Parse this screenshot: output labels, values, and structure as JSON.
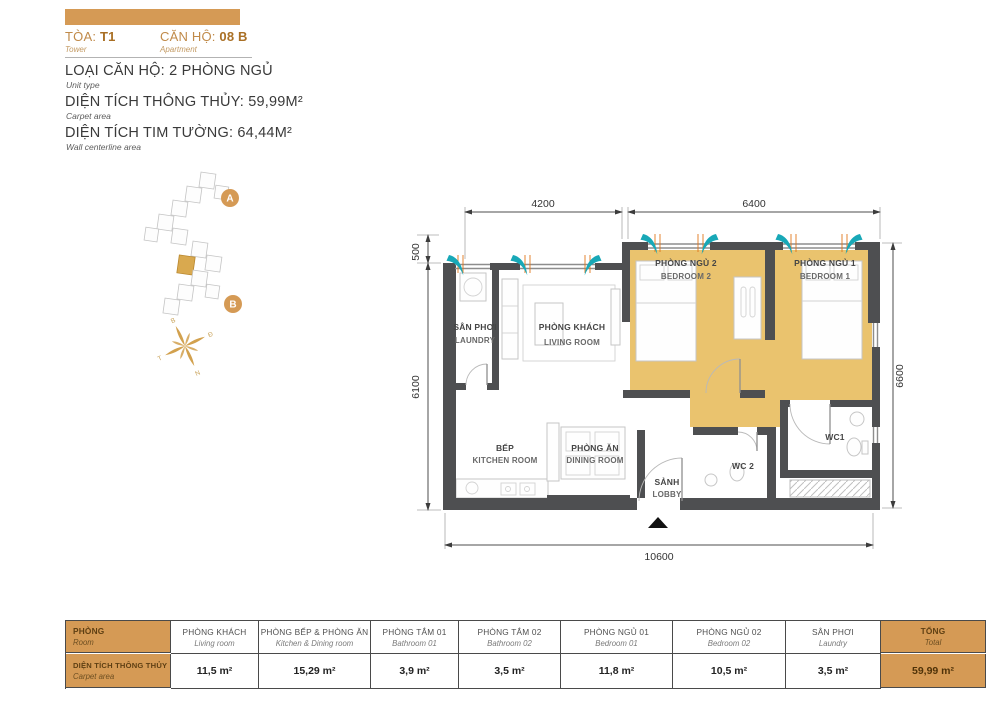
{
  "header": {
    "tower_label": "TÒA:",
    "tower_value": "T1",
    "tower_sub": "Tower",
    "apt_label": "CĂN HỘ:",
    "apt_value": "08 B",
    "apt_sub": "Apartment",
    "line1": "LOẠI CĂN HỘ: 2 PHÒNG NGỦ",
    "line1_sub": "Unit type",
    "line2": "DIỆN TÍCH THÔNG THỦY: 59,99M²",
    "line2_sub": "Carpet area",
    "line3": "DIỆN TÍCH TIM TƯỜNG: 64,44M²",
    "line3_sub": "Wall centerline area"
  },
  "tower_map": {
    "badge_a": "A",
    "badge_b": "B",
    "compass": {
      "n": "B",
      "e": "Đ",
      "s": "N",
      "w": "T"
    }
  },
  "plan": {
    "dimensions": {
      "top_left": "4200",
      "top_right": "6400",
      "left_top": "500",
      "left": "6100",
      "right": "6600",
      "bottom": "10600"
    },
    "rooms": {
      "laundry": {
        "vn": "SÂN PHƠI",
        "en": "LAUNDRY"
      },
      "living": {
        "vn": "PHÒNG KHÁCH",
        "en": "LIVING ROOM"
      },
      "bedroom2": {
        "vn": "PHÒNG NGỦ 2",
        "en": "BEDROOM 2"
      },
      "bedroom1": {
        "vn": "PHÒNG NGỦ 1",
        "en": "BEDROOM 1"
      },
      "kitchen": {
        "vn": "BẾP",
        "en": "KITCHEN ROOM"
      },
      "dining": {
        "vn": "PHÒNG ĂN",
        "en": "DINING ROOM"
      },
      "lobby": {
        "vn": "SẢNH",
        "en": "LOBBY"
      },
      "wc1": {
        "label": "WC1"
      },
      "wc2": {
        "label": "WC 2"
      }
    }
  },
  "table": {
    "row_header": {
      "vn": "PHÒNG",
      "en": "Room"
    },
    "row_area": {
      "vn": "DIỆN TÍCH THÔNG THỦY",
      "en": "Carpet area"
    },
    "columns": [
      {
        "vn": "PHÒNG KHÁCH",
        "en": "Living room",
        "value": "11,5 m²"
      },
      {
        "vn": "PHÒNG BẾP & PHÒNG ĂN",
        "en": "Kitchen & Dining room",
        "value": "15,29 m²"
      },
      {
        "vn": "PHÒNG TẮM 01",
        "en": "Bathroom 01",
        "value": "3,9 m²"
      },
      {
        "vn": "PHÒNG TẮM 02",
        "en": "Bathroom 02",
        "value": "3,5 m²"
      },
      {
        "vn": "PHÒNG NGỦ 01",
        "en": "Bedroom 01",
        "value": "11,8 m²"
      },
      {
        "vn": "PHÒNG NGỦ 02",
        "en": "Bedroom 02",
        "value": "10,5 m²"
      },
      {
        "vn": "SÂN PHƠI",
        "en": "Laundry",
        "value": "3,5 m²"
      },
      {
        "vn": "TỔNG",
        "en": "Total",
        "value": "59,99 m²"
      }
    ]
  },
  "colors": {
    "accent": "#d59a55",
    "room_fill": "#eac36e",
    "wall": "#4e4f51",
    "airflow": "#18a8b7",
    "window_tick": "#e0761c"
  }
}
